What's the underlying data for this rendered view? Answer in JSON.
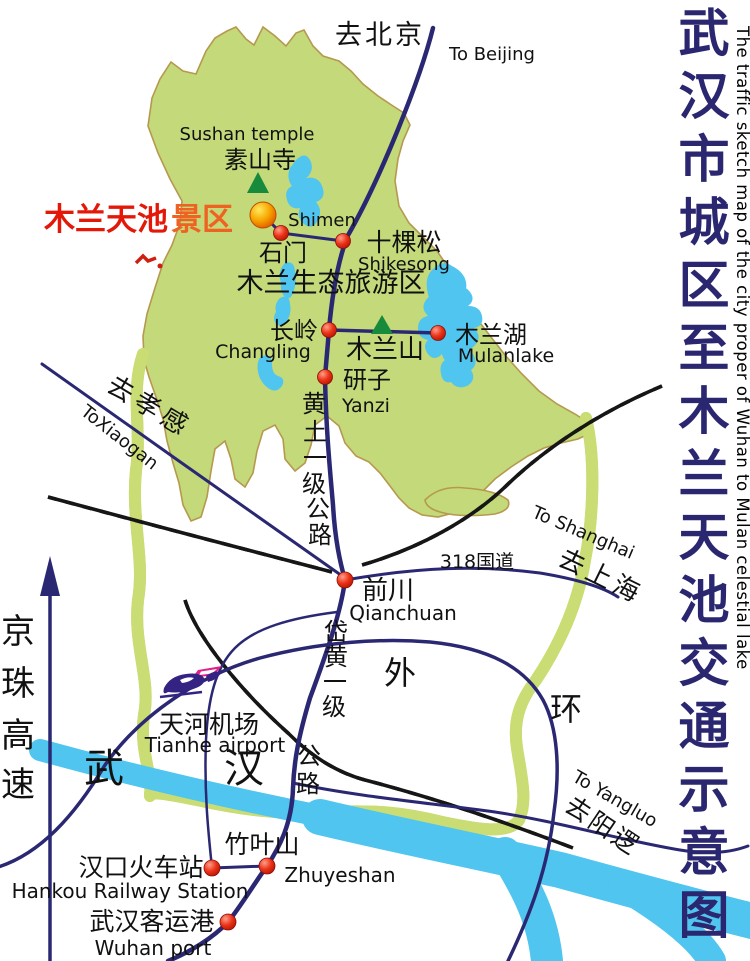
{
  "sidebar": {
    "title_cn": "武汉市城区至木兰天池交通示意图",
    "title_en": "The traffic sketch map of the city proper of Wuhan to Mulan celestial lake"
  },
  "labels": {
    "to_beijing_cn": "去北京",
    "to_beijing_en": "To Beijing",
    "sushan_en": "Sushan temple",
    "sushan_cn": "素山寺",
    "scenic_main": "木兰天池",
    "scenic_suffix": "景区",
    "shimen_en": "Shimen",
    "shimen_cn": "石门",
    "shikesong_cn": "十棵松",
    "shikesong_en": "Shikesong",
    "eco_zone_cn": "木兰生态旅游区",
    "changling_cn": "长岭",
    "changling_en": "Changling",
    "mulanshan_cn": "木兰山",
    "mulanlake_cn": "木兰湖",
    "mulanlake_en": "Mulanlake",
    "yanzi_cn": "研子",
    "yanzi_en": "Yanzi",
    "huangtu_chars": [
      "黄",
      "土",
      "一",
      "级",
      "公",
      "路"
    ],
    "to_xiaogan_cn": "去孝感",
    "to_xiaogan_en": "ToXiaogan",
    "g318_cn": "318国道",
    "to_shanghai_en": "To Shanghai",
    "to_shanghai_cn": "去上海",
    "qianchuan_cn": "前川",
    "qianchuan_en": "Qianchuan",
    "daihuang_chars": [
      "岱",
      "黄",
      "一",
      "级",
      "公",
      "路"
    ],
    "outer_ring_wai": "外",
    "outer_ring_huan": "环",
    "tianhe_cn": "天河机场",
    "tianhe_en": "Tianhe airport",
    "wuhan_wu": "武",
    "wuhan_han": "汉",
    "jingzhu_chars": [
      "京",
      "珠",
      "高",
      "速"
    ],
    "zhuyeshan_cn": "竹叶山",
    "zhuyeshan_en": "Zhuyeshan",
    "hankou_cn": "汉口火车站",
    "hankou_en": "Hankou Railway Station",
    "port_cn": "武汉客运港",
    "port_en": "Wuhan port",
    "to_yangluo_en": "To Yangluo",
    "to_yangluo_cn": "去阳逻"
  },
  "colors": {
    "region_green": "#c3d97a",
    "region_border": "#b5994e",
    "water_blue": "#4fc5ef",
    "road_navy": "#2b2873",
    "river_band_green": "#cadc74",
    "river_band_centerline": "#bb8f45",
    "railway_black": "#161616",
    "marker_red": "#e8321c",
    "scenic_ball_orange": "#f5a301",
    "scenic_text_red": "#e41808",
    "scenic_text_orange": "#ef6322",
    "title_navy": "#2a2770",
    "mountain_green": "#188a3c",
    "airport_purple": "#352384",
    "airport_magenta": "#e0218a"
  }
}
